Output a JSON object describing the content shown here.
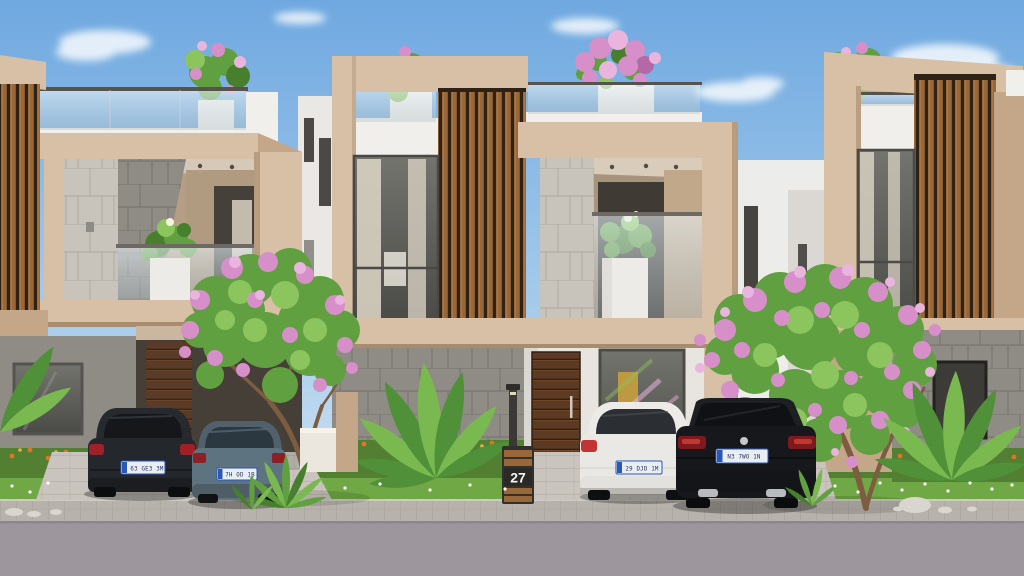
{
  "scene": {
    "description": "3D architectural render of a row of modern two-storey townhouses with wooden slat facades, roof terraces, flowering trees and four parked cars",
    "house_number": "27"
  },
  "cars": {
    "black_hatchback": {
      "label": "black hatchback",
      "plate": "63 GE3 3M"
    },
    "grey_hatchback": {
      "label": "grey-blue hatchback",
      "plate": "7H OD 1B"
    },
    "white_hatchback": {
      "label": "white hatchback",
      "plate": "29 DJD 1M"
    },
    "black_sedan": {
      "label": "black sedan",
      "plate": "N3 7WO 1N"
    }
  },
  "palette": {
    "skyTop": "#6fa8e0",
    "skyMid": "#a7cceb",
    "skyBottom": "#dcebf6",
    "beige": "#d7c0a6",
    "beigeShadow": "#c3a788",
    "beigeDark": "#a8886a",
    "whiteWall": "#f1efeb",
    "whiteShadow": "#dbd8d3",
    "wood": "#9a6738",
    "woodDark": "#2e2115",
    "tileLight": "#c8c4bb",
    "tileGrout": "#aeaaa1",
    "concrete": "#8f8c86",
    "concreteDark": "#6d6a64",
    "glassDark": "#5e5d58",
    "curtain": "#d8d1c3",
    "doorWood": "#5c3a24",
    "grass": "#6fa844",
    "grassDark": "#527f31",
    "leaf": "#61a040",
    "leafLight": "#8cc45e",
    "leafDark": "#477f2d",
    "pink": "#d68fc8",
    "pinkLight": "#e9b4dd",
    "pinkDark": "#b468a6",
    "banana": "#4f9038",
    "bananaLight": "#7ab94f",
    "orangeFlower": "#df7527",
    "orangeLight": "#f2b03c",
    "paver": "#b7b2ab",
    "paverLight": "#c9c4bd",
    "road": "#9d969c",
    "carBlack": "#24272b",
    "carGrey": "#5e7380",
    "carWhite": "#e9e8e4",
    "carSedan": "#17181c",
    "plateBg": "#e9eef4",
    "plateBlue": "#2b57b5",
    "post": "#3a3936",
    "trunk": "#7d5c40"
  }
}
